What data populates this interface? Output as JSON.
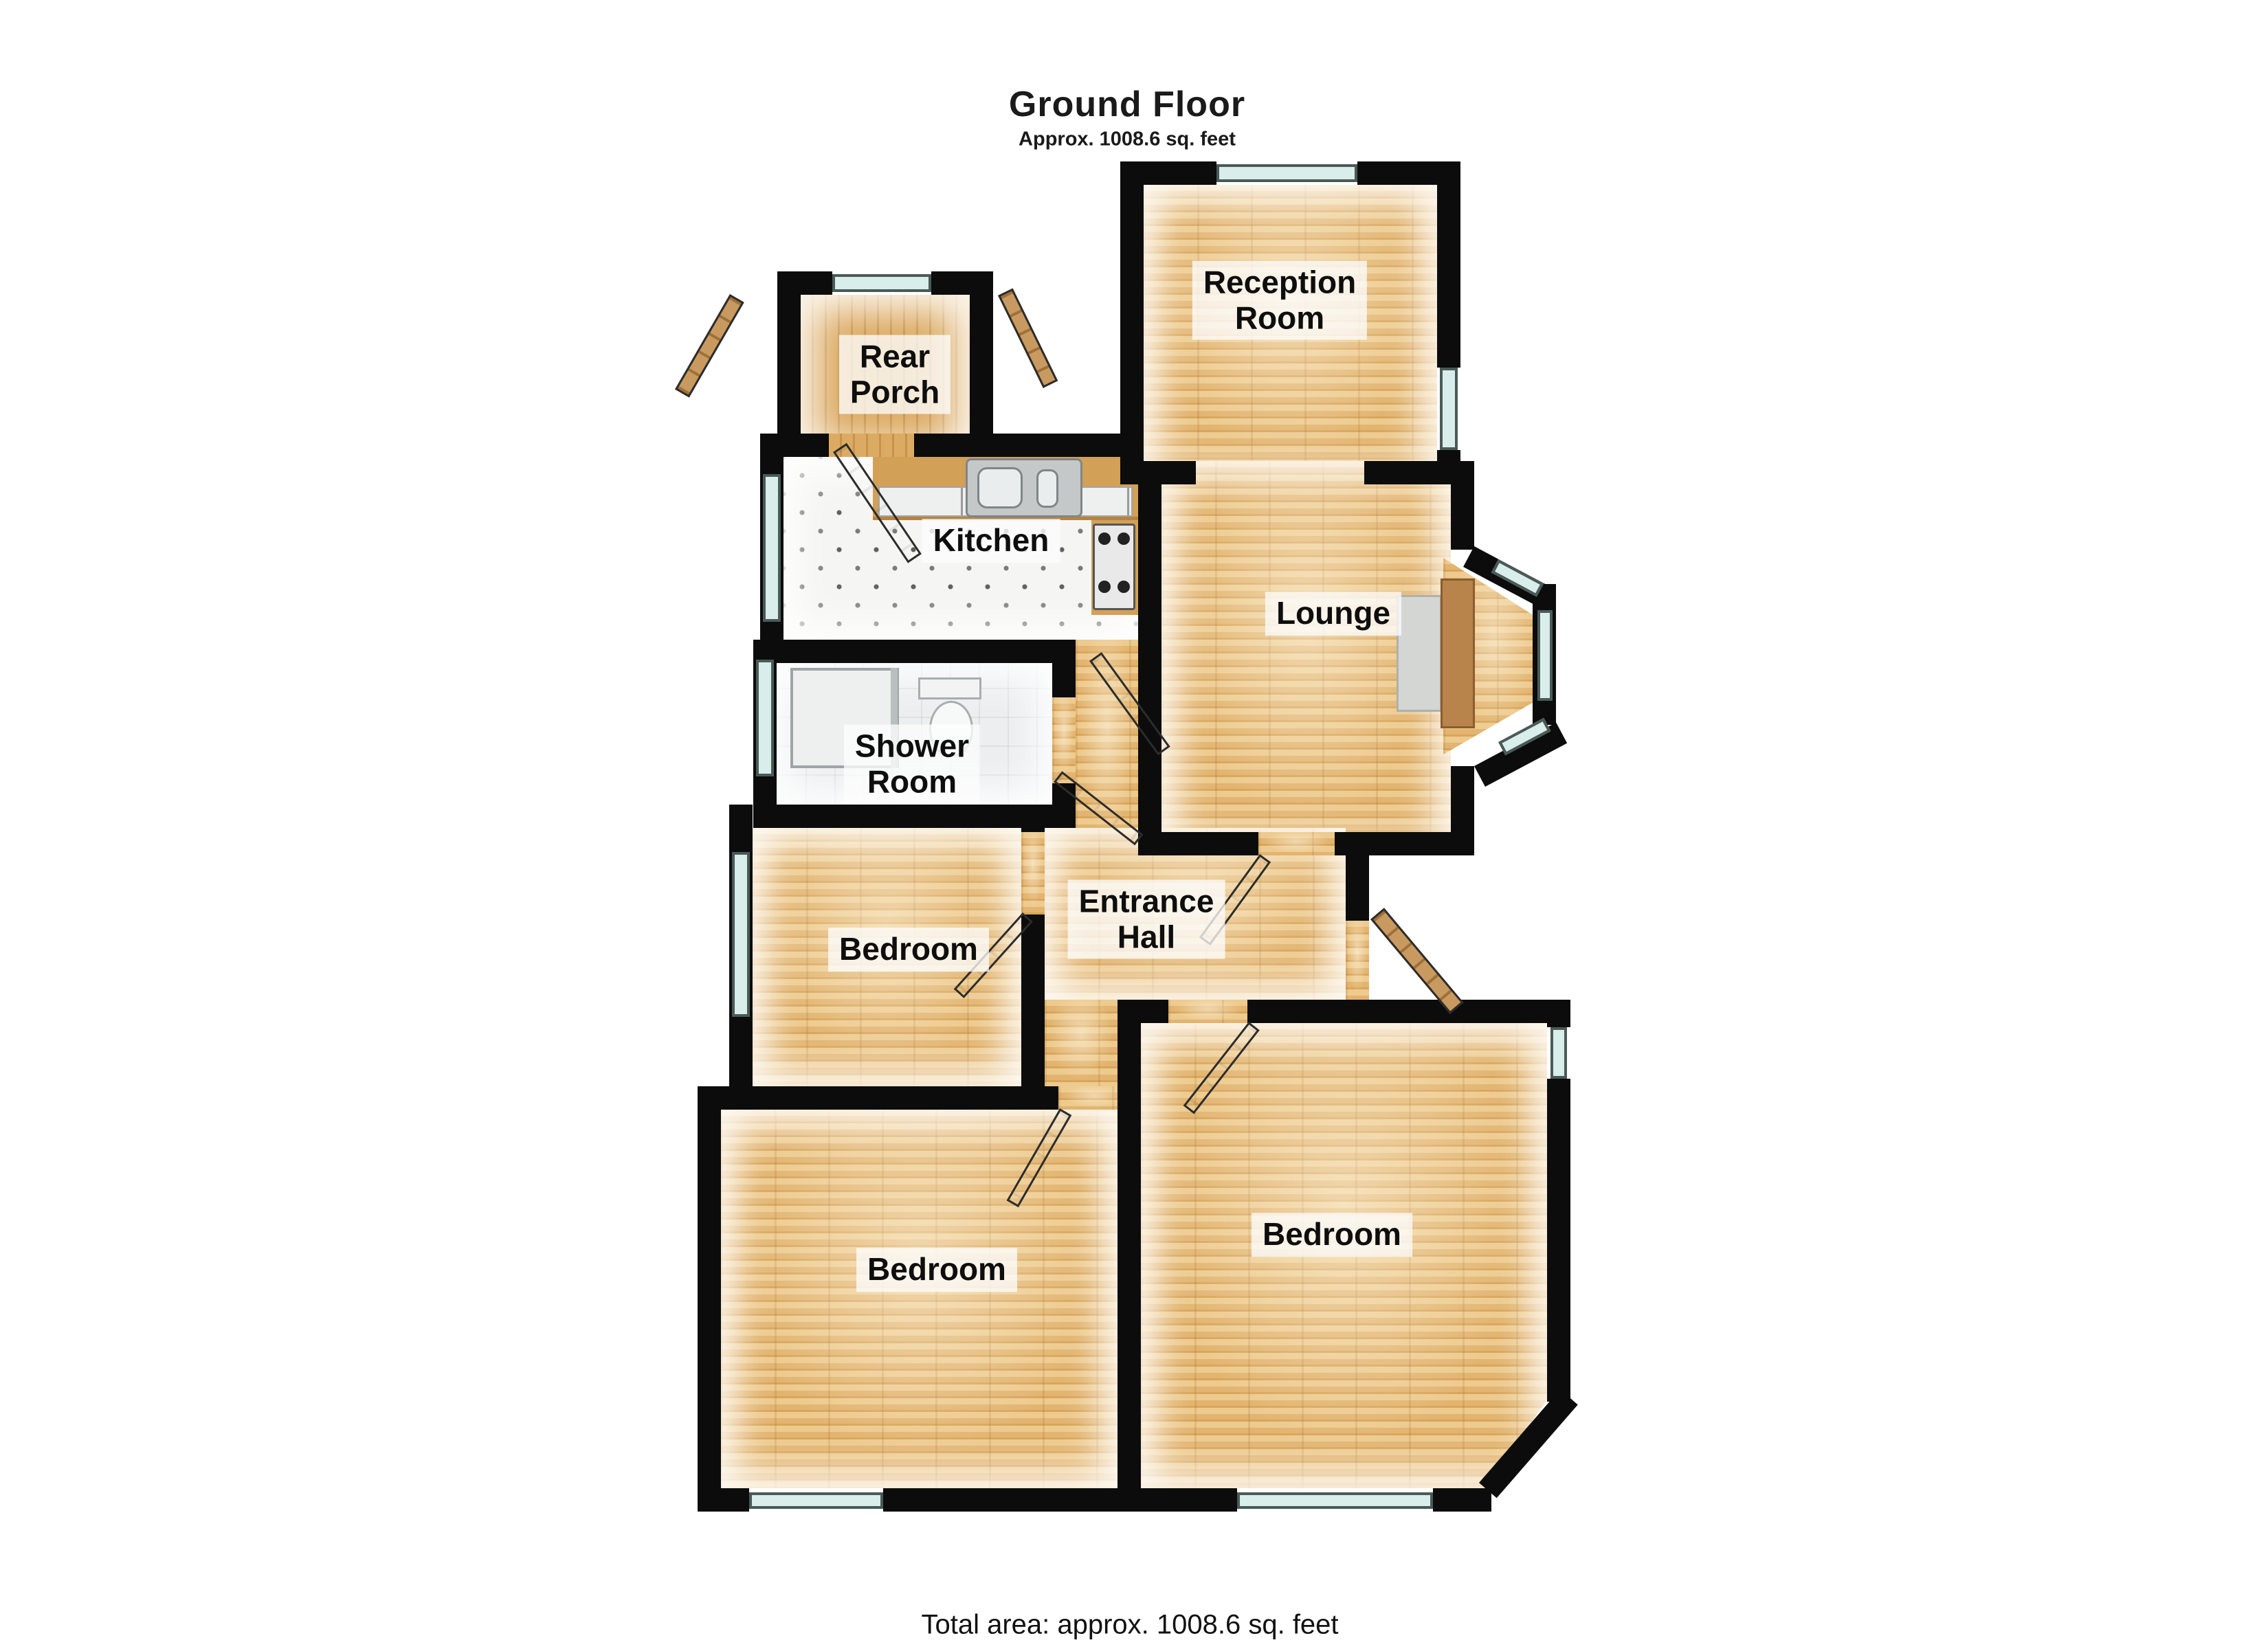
{
  "header": {
    "title": "Ground Floor",
    "subtitle": "Approx. 1008.6 sq. feet"
  },
  "footer": {
    "total_area": "Total area: approx. 1008.6 sq. feet"
  },
  "rooms": {
    "reception_room": {
      "label": "Reception\nRoom"
    },
    "rear_porch": {
      "label": "Rear\nPorch"
    },
    "kitchen": {
      "label": "Kitchen"
    },
    "lounge": {
      "label": "Lounge"
    },
    "shower_room": {
      "label": "Shower\nRoom"
    },
    "entrance_hall": {
      "label": "Entrance\nHall"
    },
    "bedroom_middle": {
      "label": "Bedroom"
    },
    "bedroom_bottom_left": {
      "label": "Bedroom"
    },
    "bedroom_bottom_right": {
      "label": "Bedroom"
    }
  },
  "colors": {
    "wall_black": "#0c0c0c",
    "wood_floor": "#e4b873",
    "kitchen_tile": "#f5f5f3",
    "shower_tile": "#eceef0",
    "window_glass": "#d9edea",
    "door_wood": "#c08c4a",
    "label_background": "rgba(252,252,252,0.78)"
  }
}
